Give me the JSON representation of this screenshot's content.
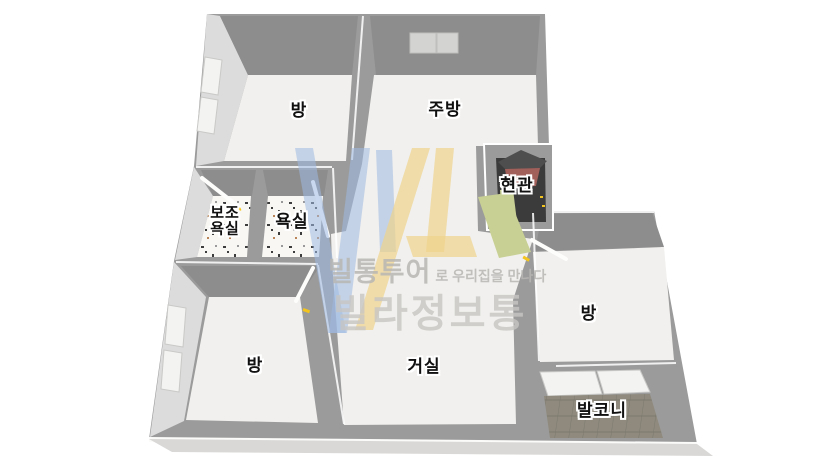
{
  "page": {
    "background": "#ffffff"
  },
  "floorplan": {
    "rooms": {
      "bedroom_top": {
        "label": "방"
      },
      "kitchen": {
        "label": "주방"
      },
      "entrance": {
        "label": "현관"
      },
      "aux_bathroom": {
        "label": "보조\n욕실"
      },
      "bathroom": {
        "label": "욕실"
      },
      "bedroom_left": {
        "label": "방"
      },
      "living_room": {
        "label": "거실"
      },
      "bedroom_right": {
        "label": "방"
      },
      "balcony": {
        "label": "발코니"
      }
    },
    "watermark": {
      "logo_letters": "VL",
      "tagline_strong": "빌통투어",
      "tagline_rest": "로 우리집을 만나다",
      "brand": "빌라정보통"
    },
    "palette": {
      "page_bg": "#ffffff",
      "wall_top": "#9b9b9b",
      "wall_dark": "#8d8d8d",
      "wall_light": "#dcdcdc",
      "floor": "#f1f0ee",
      "bath_floor": "#f8f7f4",
      "slab": "#d9d8d6",
      "entrance_floor": "#3b3b3b",
      "entrance_roof": "#a2605b",
      "entrance_roof_top": "#4e4e4e",
      "mat_green": "#c9d094",
      "balcony_tile": "#8f8a7d",
      "balcony_grout": "#7d7970",
      "logo_blue": "#9fb9e2",
      "logo_yellow": "#f0d38c",
      "watermark_text": "#b8b7b4",
      "watermark_text2": "#c7c6c3",
      "label_color": "#111111",
      "accent_tick": "#f2c41d"
    }
  }
}
